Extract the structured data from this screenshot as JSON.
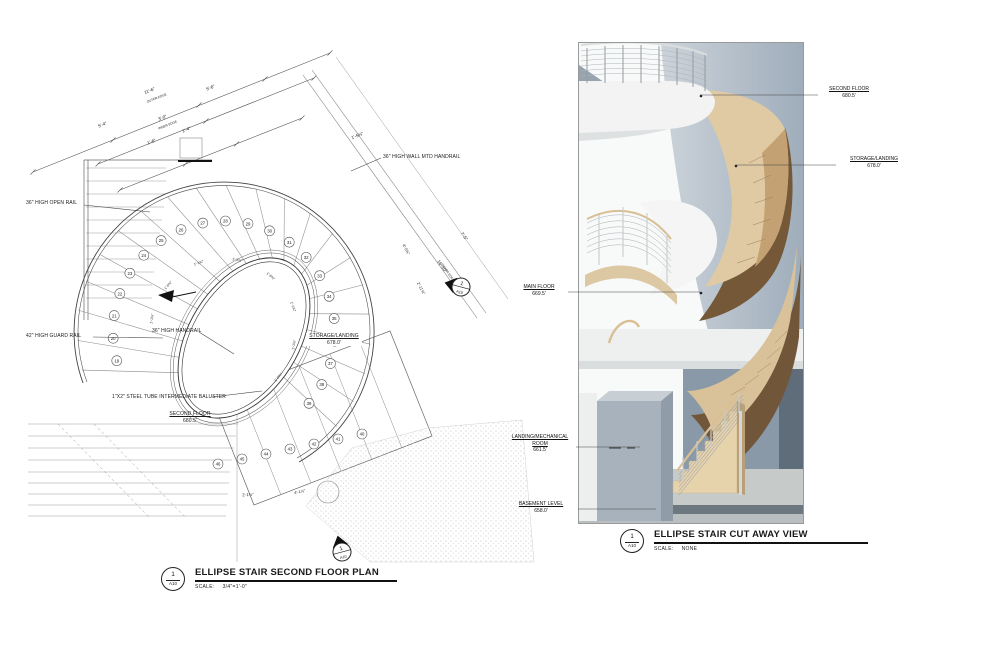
{
  "sheet": {
    "background": "#ffffff",
    "line_color": "#333333"
  },
  "plan": {
    "title": "ELLIPSE STAIR SECOND FLOOR PLAN",
    "scale_label": "SCALE:",
    "scale_value": "3/4\"=1'-0\"",
    "marker": {
      "detail": "1",
      "sheet": "A10"
    },
    "callouts": {
      "open_rail": "36\" HIGH OPEN RAIL",
      "wall_handrail": "36\" HIGH WALL MTD HANDRAIL",
      "guard_rail": "42\" HIGH GUARD RAIL",
      "handrail": "36\" HIGH HANDRAIL",
      "baluster": "1\"X2\" STEEL TUBE INTERMEDIATE BALUSTER"
    },
    "levels": {
      "second_floor": {
        "label": "SECOND FLOOR",
        "elev": "680.5'"
      },
      "storage_landing": {
        "label": "STORAGE/LANDING",
        "elev": "678.0'"
      }
    },
    "dims": {
      "d1": "5'-4\"",
      "d2": "11'-6\"",
      "d2b": "OUTER EDGE",
      "d3": "5'-6\"",
      "d4": "3'-0\"",
      "d4b": "INNER EDGE",
      "d5": "1'-4\"",
      "d6": "1'-6\"",
      "d7": "1'-5¾\"",
      "d8": "16'-10\"",
      "d8b": "OUTER EDGE",
      "d9": "7'-5\"",
      "d10": "2'-11⅝\"",
      "d11": "4'-0⅝\"",
      "d12": "2'-1¼\"",
      "d13": "4'-1⅞\"",
      "t1": "1'-1⅜\"",
      "t2": "1'-0⅝\"",
      "t3": "1'-1⅝\""
    },
    "tread_numbers_arc": [
      "19",
      "20",
      "21",
      "22",
      "23",
      "24",
      "25",
      "26",
      "27",
      "28",
      "29",
      "30",
      "31",
      "32",
      "33",
      "34",
      "35",
      "36",
      "37",
      "38",
      "39"
    ],
    "tread_numbers_flight": [
      "40",
      "41",
      "42",
      "43",
      "44",
      "45",
      "46"
    ]
  },
  "cutaway": {
    "title": "ELLIPSE STAIR CUT AWAY VIEW",
    "scale_label": "SCALE:",
    "scale_value": "NONE",
    "marker": {
      "detail": "1",
      "sheet": "A10"
    },
    "levels": [
      {
        "label": "SECOND FLOOR",
        "label2": "",
        "elev": "680.5'"
      },
      {
        "label": "STORAGE/LANDING",
        "label2": "",
        "elev": "678.0'"
      },
      {
        "label": "MAIN FLOOR",
        "label2": "",
        "elev": "669.5'"
      },
      {
        "label": "LANDING/MECHANICAL",
        "label2": "ROOM",
        "elev": "661.5'"
      },
      {
        "label": "BASEMENT LEVEL",
        "label2": "",
        "elev": "658.0'"
      }
    ],
    "colors": {
      "wall": "#a8b4c0",
      "wall_dark": "#5f6d7a",
      "wood_light": "#e0caa3",
      "wood_dark": "#745838",
      "slab": "#f2f3f2",
      "floor": "#c6cbca",
      "box": "#a7b2bc"
    }
  }
}
